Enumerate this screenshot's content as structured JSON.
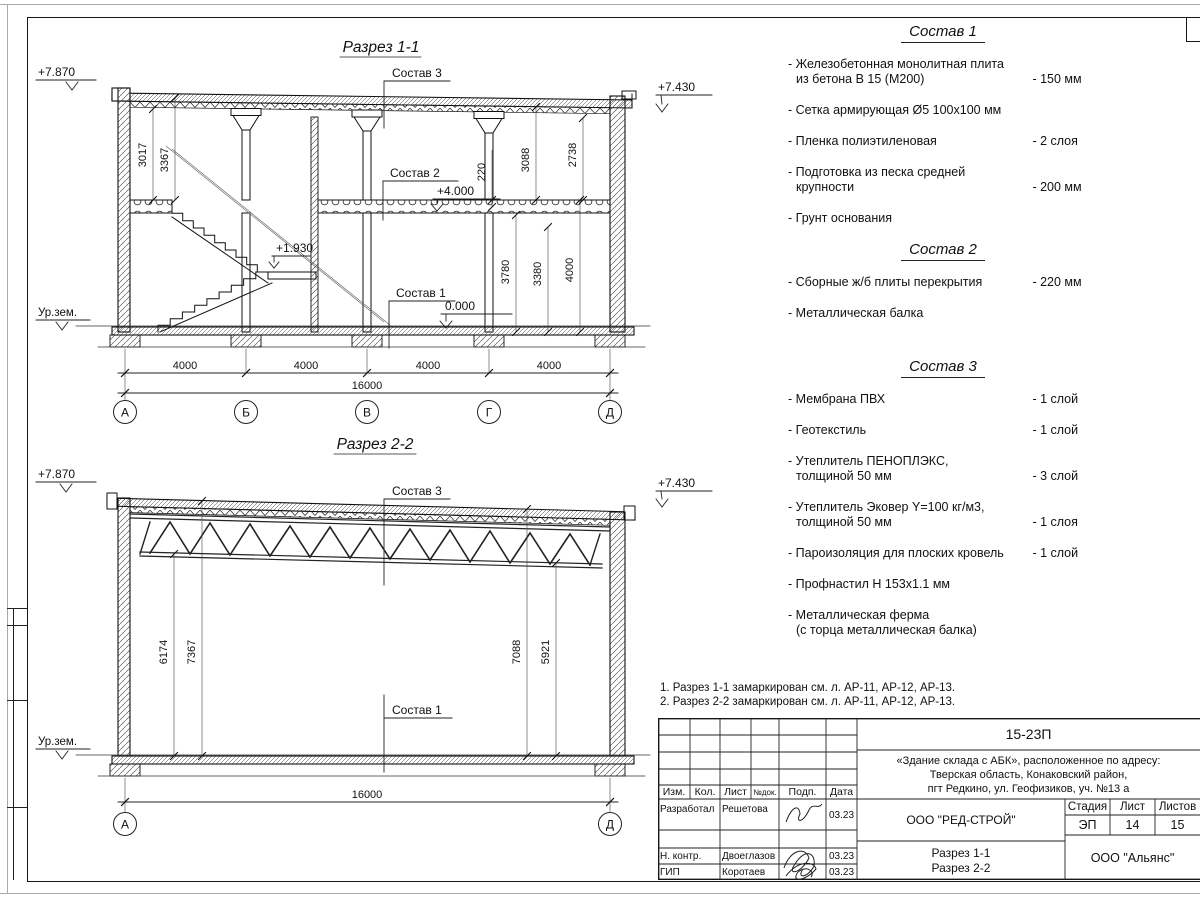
{
  "sections": {
    "s1": {
      "title": "Разрез 1-1",
      "elev_left": "+7.870",
      "elev_right": "+7.430",
      "elev_mid": "+4.000",
      "elev_zero": "0.000",
      "elev_landing": "+1.930",
      "ground": "Ур.зем.",
      "lead_s3": "Состав 3",
      "lead_s2": "Состав 2",
      "lead_s1": "Состав 1",
      "dim_3017": "3017",
      "dim_3367": "3367",
      "dim_220": "220",
      "dim_3088": "3088",
      "dim_2738": "2738",
      "dim_3780": "3780",
      "dim_3380": "3380",
      "dim_4000v": "4000",
      "dims_bottom": [
        "4000",
        "4000",
        "4000",
        "4000"
      ],
      "dim_total": "16000",
      "axes": [
        "А",
        "Б",
        "В",
        "Г",
        "Д"
      ]
    },
    "s2": {
      "title": "Разрез 2-2",
      "elev_left": "+7.870",
      "elev_right": "+7.430",
      "ground": "Ур.зем.",
      "lead_s3": "Состав 3",
      "lead_s1": "Состав 1",
      "dim_6174": "6174",
      "dim_7367": "7367",
      "dim_7088": "7088",
      "dim_5921": "5921",
      "dim_total": "16000",
      "axes": [
        "А",
        "Д"
      ]
    }
  },
  "materials": {
    "s1": {
      "title": "Состав 1",
      "items": [
        {
          "name": "- Железобетонная  монолитная плита\nиз бетона В 15 (М200)",
          "value": "- 150 мм"
        },
        {
          "name": "- Сетка армирующая Ø5 100х100 мм",
          "value": ""
        },
        {
          "name": "- Пленка полиэтиленовая",
          "value": "-  2 слоя"
        },
        {
          "name": "- Подготовка из песка средней\nкрупности",
          "value": "- 200 мм"
        },
        {
          "name": "- Грунт основания",
          "value": ""
        }
      ]
    },
    "s2": {
      "title": "Состав 2",
      "items": [
        {
          "name": "- Сборные ж/б плиты перекрытия",
          "value": "- 220 мм"
        },
        {
          "name": "- Металлическая балка",
          "value": ""
        }
      ]
    },
    "s3": {
      "title": "Состав 3",
      "items": [
        {
          "name": "- Мембрана ПВХ",
          "value": "- 1 слой"
        },
        {
          "name": "- Геотекстиль",
          "value": "- 1 слой"
        },
        {
          "name": "- Утеплитель ПЕНОПЛЭКС,\nтолщиной 50 мм",
          "value": "- 3 слой"
        },
        {
          "name": "- Утеплитель Эковер Y=100 кг/м3,\nтолщиной 50 мм",
          "value": "- 1 слоя"
        },
        {
          "name": "- Пароизоляция для плоских кровель",
          "value": "- 1 слой"
        },
        {
          "name": "- Профнастил Н 153х1.1 мм",
          "value": ""
        },
        {
          "name": "- Металлическая ферма\n(с торца металлическая балка)",
          "value": ""
        }
      ]
    }
  },
  "notes": [
    "1. Разрез 1-1 замаркирован см. л. АР-11, АР-12, АР-13.",
    "2. Разрез 2-2 замаркирован см. л. АР-11, АР-12, АР-13."
  ],
  "titleblock": {
    "code": "15-23П",
    "project1": "«Здание склада с АБК», расположенное по адресу:",
    "project2": "Тверская область, Конаковский район,",
    "project3": "пгт Редкино, ул. Геофизиков, уч. №13 а",
    "company": "ООО \"РЕД-СТРОЙ\"",
    "doc1": "Разрез 1-1",
    "doc2": "Разрез 2-2",
    "contractor": "ООО \"Альянс\"",
    "stage_label": "Стадия",
    "sheet_label": "Лист",
    "sheets_label": "Листов",
    "stage": "ЭП",
    "sheet_num": "14",
    "sheets_num": "15",
    "cols": [
      "Изм.",
      "Кол.",
      "Лист",
      "№док.",
      "Подп.",
      "Дата"
    ],
    "rows": [
      {
        "role": "Разработал",
        "name": "Решетова",
        "date": "03.23"
      },
      {
        "role": "Н. контр.",
        "name": "Двоеглазов",
        "date": "03.23"
      },
      {
        "role": "ГИП",
        "name": "Коротаев",
        "date": "03.23"
      }
    ]
  }
}
